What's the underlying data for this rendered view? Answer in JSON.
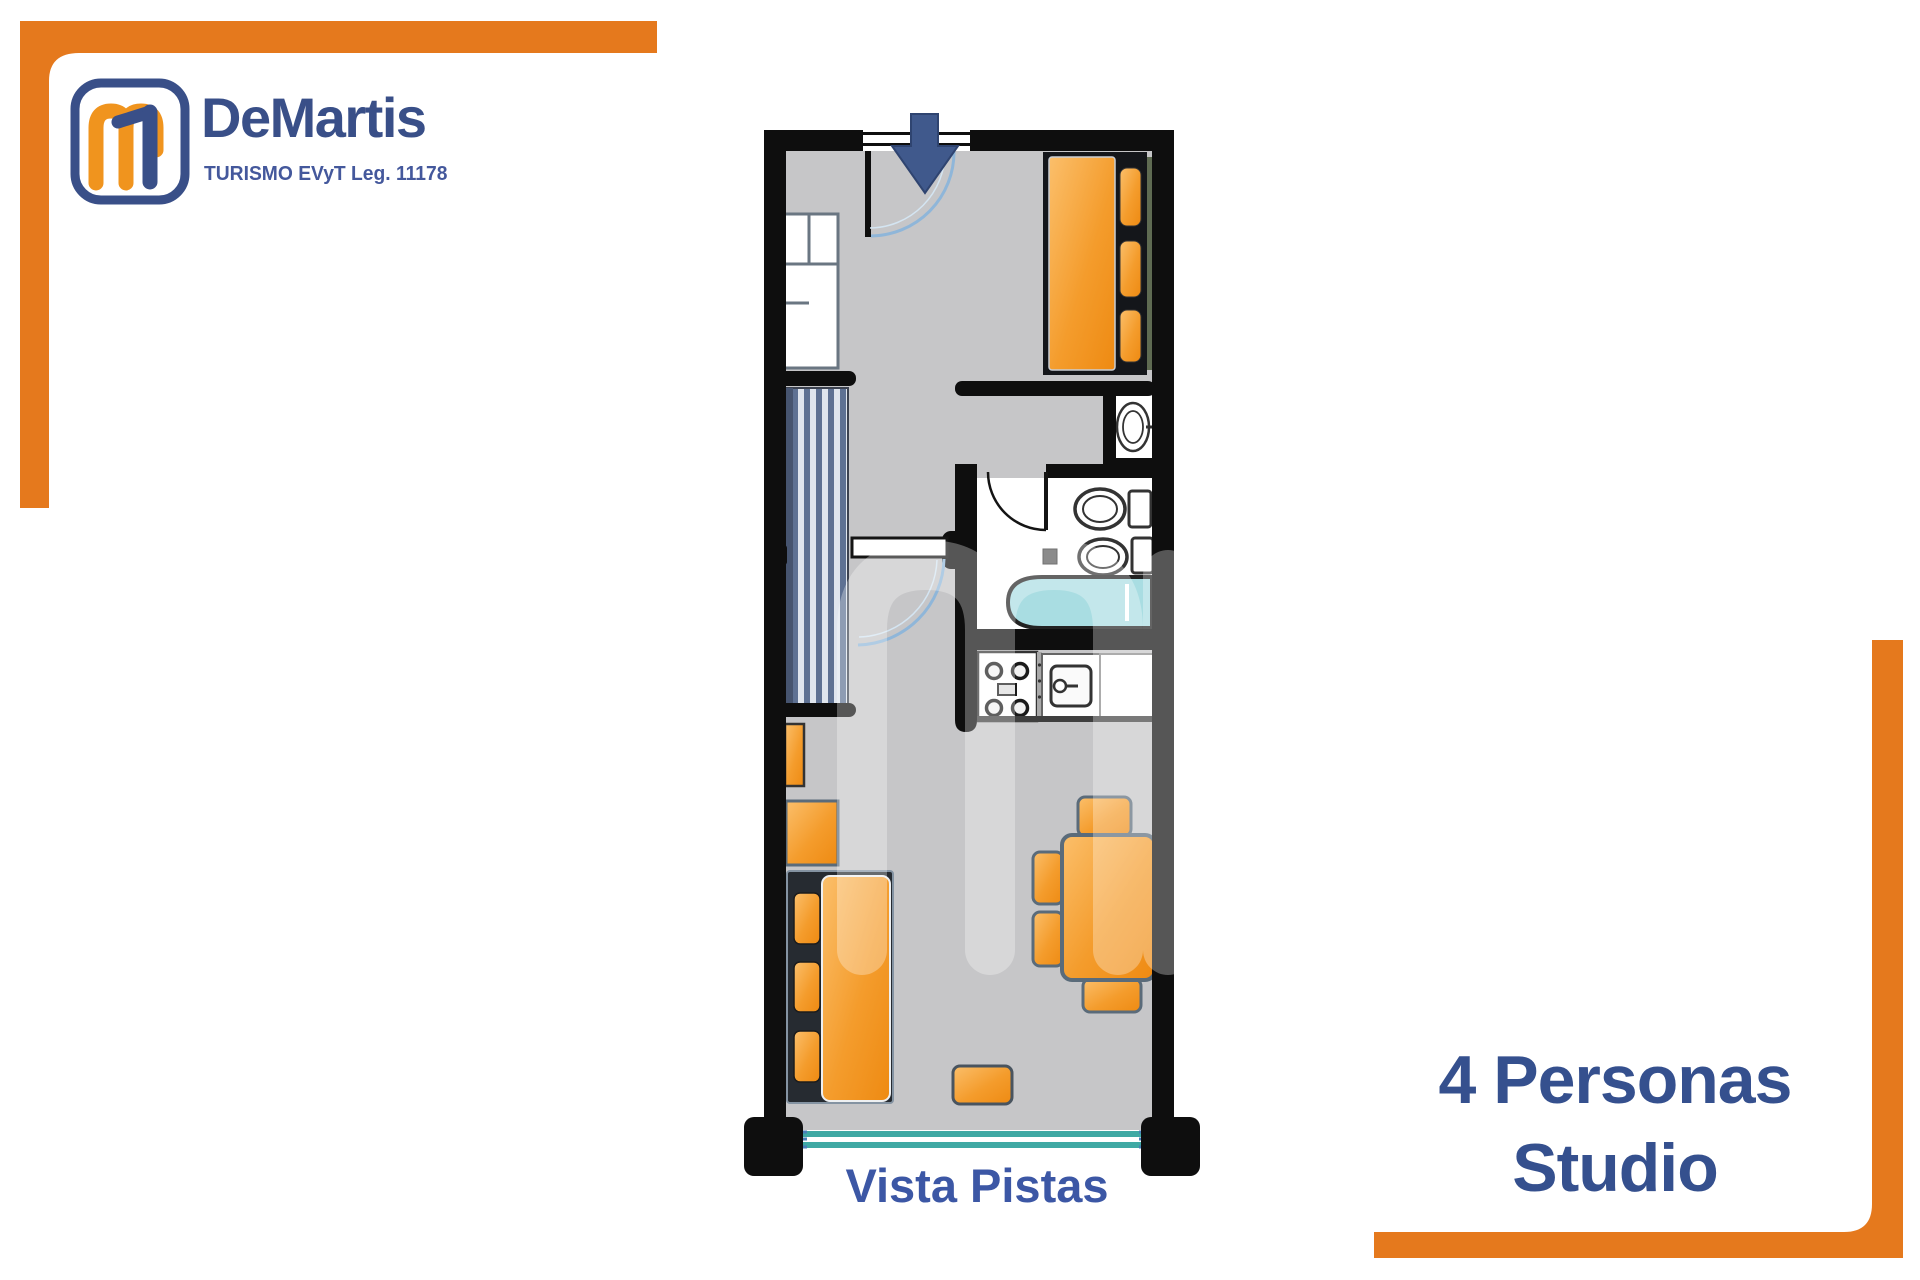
{
  "page": {
    "width": 1920,
    "height": 1280,
    "background": "#ffffff"
  },
  "brand": {
    "name": "DeMartis",
    "tagline": "TURISMO EVyT Leg. 11178",
    "monogram_letter": "m",
    "colors": {
      "frame_orange": "#e5791d",
      "brand_blue": "#394f88",
      "logo_orange": "#f0941e"
    }
  },
  "floorplan": {
    "view_label": "Vista Pistas",
    "watermark_letter": "m",
    "colors": {
      "wall": "#0e0e0e",
      "floor": "#c6c6c8",
      "furniture_orange": "#f09a2e",
      "window_teal": "#3fa9a4",
      "bathtub_cyan": "#a9dde2",
      "door_arc_blue": "#8fb6d9",
      "entrance_arrow_blue": "#40598c"
    },
    "features": [
      "entrance-arrow",
      "entry-door",
      "entry-closet",
      "double-bed",
      "washbasin",
      "bathroom-door",
      "toilet",
      "bidet",
      "bathtub",
      "striped-wardrobe",
      "hall-door",
      "stove",
      "kitchen-sink",
      "kitchen-counter",
      "wall-shelf",
      "side-table",
      "sofa-bed",
      "ottoman",
      "dining-table",
      "dining-chairs",
      "balcony-window",
      "pillars"
    ]
  },
  "caption": {
    "line1": "4 Personas",
    "line2": "Studio",
    "color": "#35508e"
  }
}
